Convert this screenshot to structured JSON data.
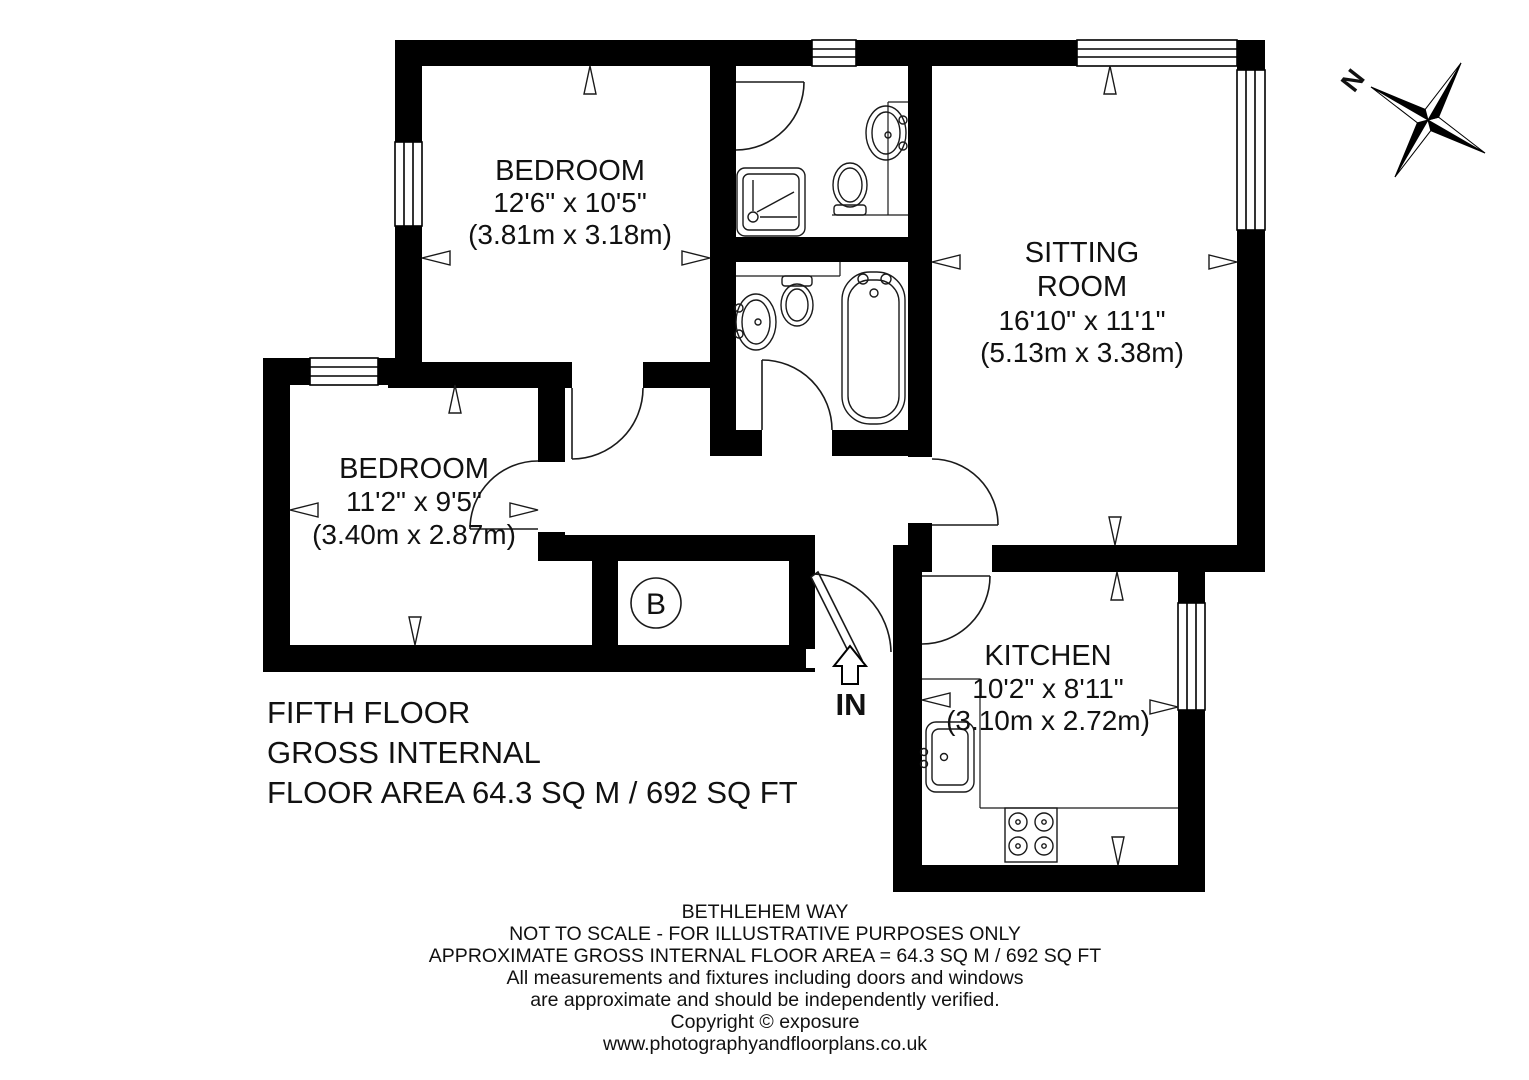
{
  "colors": {
    "wall": "#000000",
    "background": "#ffffff",
    "line": "#1a1a1a"
  },
  "rooms": {
    "bedroom1": {
      "name": "BEDROOM",
      "dims_ft": "12'6\" x 10'5\"",
      "dims_m": "(3.81m x 3.18m)"
    },
    "bedroom2": {
      "name": "BEDROOM",
      "dims_ft": "11'2\" x 9'5\"",
      "dims_m": "(3.40m x 2.87m)"
    },
    "sitting_room": {
      "name_line1": "SITTING",
      "name_line2": "ROOM",
      "dims_ft": "16'10\" x 11'1\"",
      "dims_m": "(5.13m x 3.38m)"
    },
    "kitchen": {
      "name": "KITCHEN",
      "dims_ft": "10'2\" x 8'11\"",
      "dims_m": "(3.10m x 2.72m)"
    }
  },
  "labels": {
    "entrance": "IN",
    "boiler_cupboard": "B",
    "compass_north": "N"
  },
  "title_block": {
    "line1": "FIFTH FLOOR",
    "line2": "GROSS INTERNAL",
    "line3": "FLOOR AREA 64.3 SQ M / 692 SQ FT"
  },
  "footer": {
    "line1": "BETHLEHEM WAY",
    "line2": "NOT TO SCALE - FOR ILLUSTRATIVE PURPOSES ONLY",
    "line3": "APPROXIMATE GROSS INTERNAL FLOOR AREA = 64.3 SQ M / 692 SQ FT",
    "line4": "All measurements and fixtures including doors and windows",
    "line5": "are approximate and should be independently verified.",
    "line6": "Copyright ©  exposure",
    "line7": "www.photographyandfloorplans.co.uk"
  }
}
